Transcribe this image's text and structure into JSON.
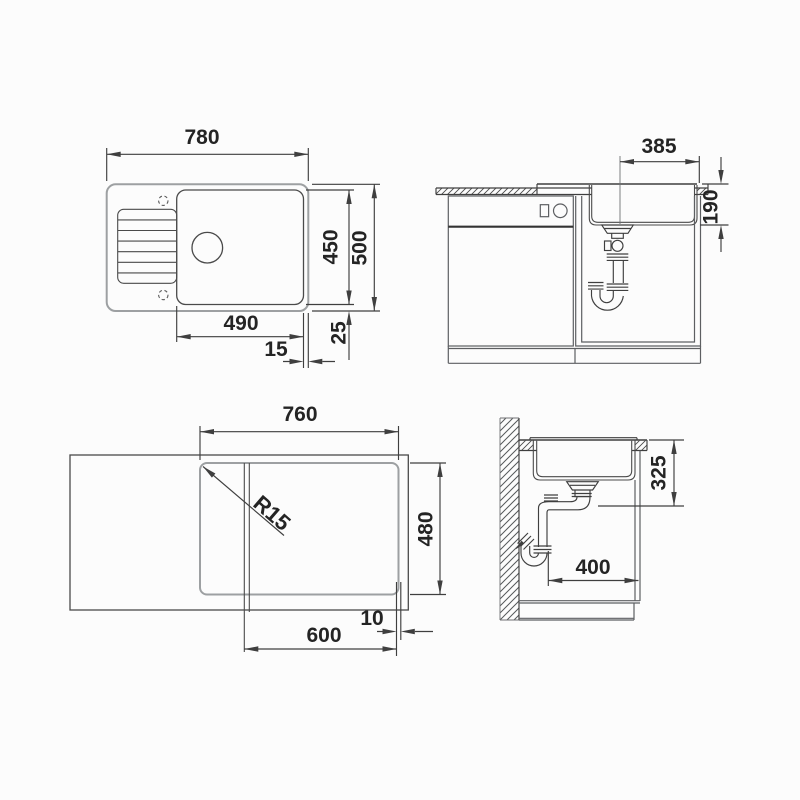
{
  "drawing_title": "Sink installation technical drawing",
  "views": {
    "top": {
      "overall_width": "780",
      "bowl_depth": "450",
      "overall_depth": "500",
      "bowl_width": "490",
      "offset_right": "15",
      "offset_bottom": "25"
    },
    "front_section": {
      "drain_offset": "385",
      "bowl_height": "190"
    },
    "cutout": {
      "width": "760",
      "depth": "480",
      "corner_radius": "R15",
      "cabinet_width": "600",
      "edge_gap": "10"
    },
    "side_section": {
      "install_height": "325",
      "clearance": "400"
    }
  },
  "colors": {
    "line": "#3f3f3f",
    "light_edge": "#9da0a2",
    "cabinet": "#5d5f62",
    "background": "#fcfcfc",
    "text": "#242424"
  }
}
